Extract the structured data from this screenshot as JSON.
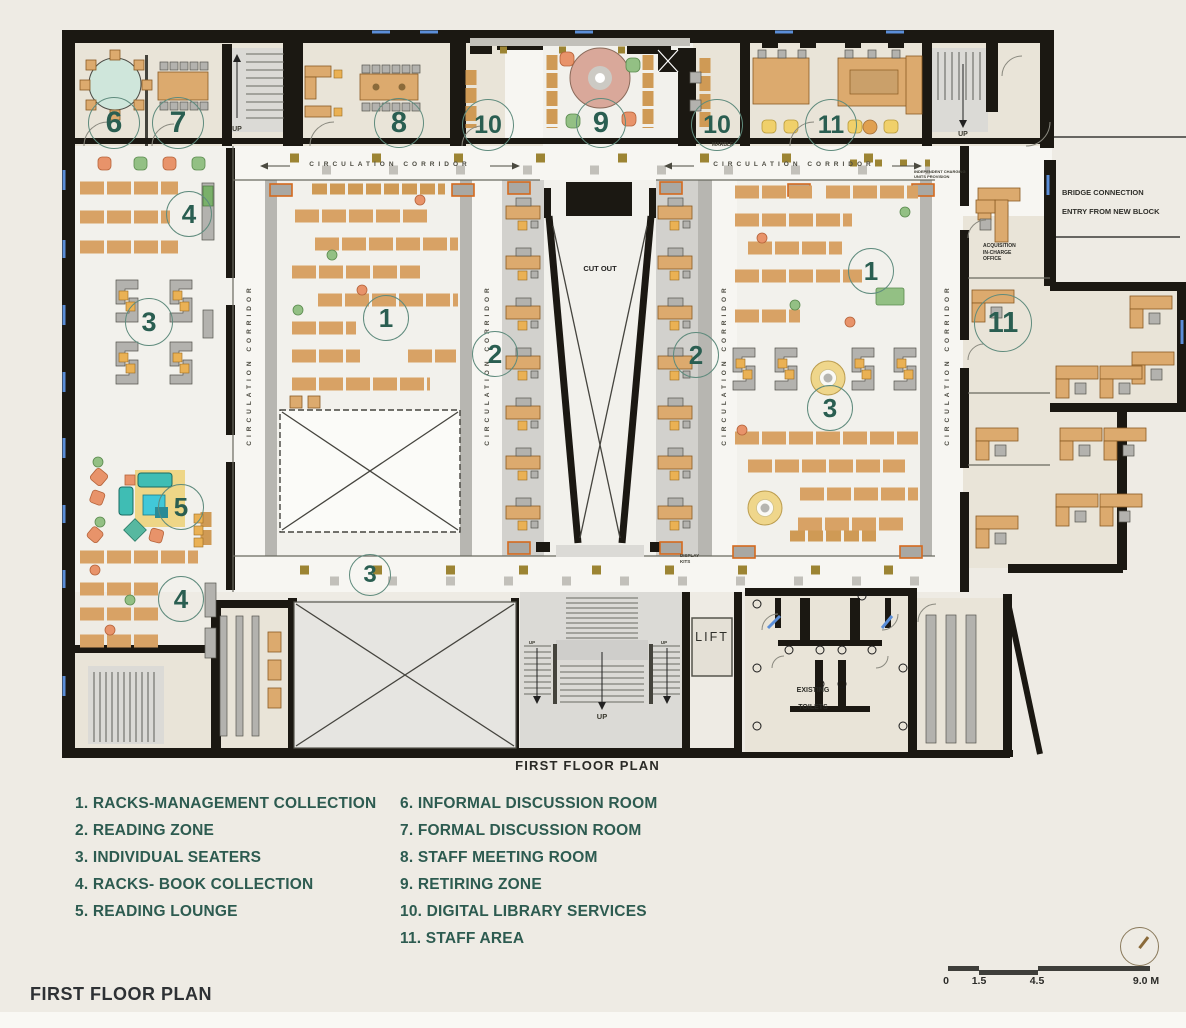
{
  "page": {
    "title": "FIRST FLOOR PLAN"
  },
  "plan": {
    "caption": "FIRST FLOOR PLAN",
    "labels": {
      "circulation_corridor": "CIRCULATION CORRIDOR",
      "cut_out": "CUT OUT",
      "up": "UP",
      "lift": "LIFT",
      "existing_toilets_line1": "EXISTING",
      "existing_toilets_line2": "TOILETS",
      "acquisition_office": "ACQUISITION IN-CHARGE OFFICE",
      "bridge_line1": "BRIDGE CONNECTION",
      "bridge_line2": "ENTRY FROM NEW BLOCK",
      "display": "DISPLAY KITS",
      "marble": "MARBLE",
      "independent_charging": "INDEPENDENT CHARGING UNITS PROVISION"
    },
    "markers": [
      "6",
      "7",
      "8",
      "10",
      "9",
      "10",
      "11",
      "4",
      "3",
      "1",
      "2",
      "2",
      "1",
      "3",
      "5",
      "4",
      "3",
      "11"
    ]
  },
  "legend": {
    "left": [
      "1. RACKS-MANAGEMENT COLLECTION",
      "2. READING ZONE",
      "3. INDIVIDUAL SEATERS",
      "4. RACKS- BOOK COLLECTION",
      "5. READING LOUNGE"
    ],
    "right": [
      "6. INFORMAL DISCUSSION ROOM",
      "7. FORMAL DISCUSSION ROOM",
      "8. STAFF MEETING ROOM",
      "9. RETIRING ZONE",
      "10. DIGITAL LIBRARY SERVICES",
      "11. STAFF AREA"
    ]
  },
  "scale_bar": {
    "ticks": [
      "0",
      "1.5",
      "4.5",
      "9.0 M"
    ]
  },
  "colors": {
    "accent_teal": "#2d5c50",
    "wall_black": "#1b1812",
    "wood": "#d8a265",
    "paper": "#eeebe4",
    "window_blue": "#5b8ed8"
  }
}
